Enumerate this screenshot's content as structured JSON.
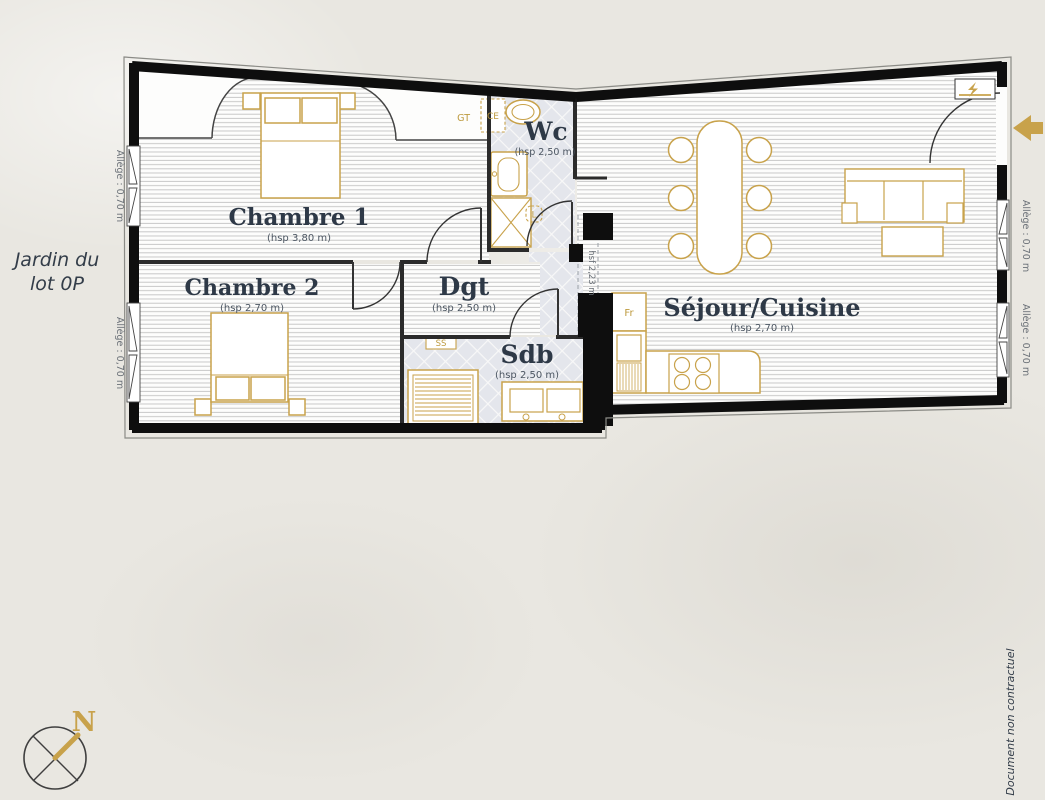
{
  "rooms": {
    "chambre1": {
      "name": "Chambre 1",
      "height": "(hsp 3,80 m)"
    },
    "chambre2": {
      "name": "Chambre 2",
      "height": "(hsp 2,70 m)"
    },
    "dgt": {
      "name": "Dgt",
      "height": "(hsp 2,50 m)"
    },
    "wc": {
      "name": "Wc",
      "height": "(hsp 2,50 m)"
    },
    "sdb": {
      "name": "Sdb",
      "height": "(hsp 2,50 m)"
    },
    "sejour": {
      "name": "Séjour/Cuisine",
      "height": "(hsp 2,70 m)"
    }
  },
  "fixtures": {
    "gaine_technique": "GT",
    "chauffe_eau": "CE",
    "seche_serviettes": "SS",
    "fridge": "Fr",
    "lave_linge": "L"
  },
  "dimensions": {
    "window_sill": "Allège : 0,70 m",
    "beam_height": "hsf 2,23 m"
  },
  "outside": {
    "garden_line1": "Jardin du",
    "garden_line2": "lot 0P",
    "compass_north": "N",
    "disclaimer": "Document non contractuel"
  },
  "colors": {
    "accent_gold": "#c8a24b",
    "label_navy": "#2e3947",
    "wall_black": "#0e0e0e",
    "tile_background": "#e4e6ec",
    "paper_background": "#e9e7e1"
  }
}
